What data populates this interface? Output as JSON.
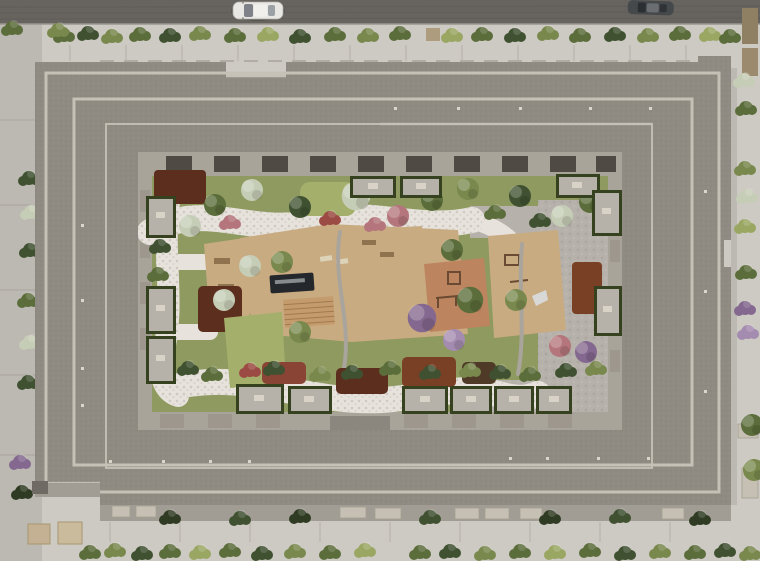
{
  "scene": {
    "type": "aerial-architectural-render",
    "description": "Top-down aerial render of a large rectangular residential block with stepped grey flat roofs and light parapet lines enclosing a landscaped inner courtyard. The courtyard holds winding white stone paths, a grey cobble plaza, lawns, dark red mulch beds, flowering shrubs, trees, tan and terracotta playgrounds, a dark reflecting pool with a wooden deck, and rows of private hedge-bordered terraces. Around the block: a dark asphalt road with a white car and a dark car at top, hedge strips, light sidewalks, a side street at left, and a hedge row at bottom."
  },
  "palette": {
    "road": "#67645f",
    "street": "#bcb8b2",
    "walk": "#cdc9c3",
    "roof": "#8f8a82",
    "parapet": "#c6c1b7",
    "facade": "#a9a49a",
    "facadedark": "#4f4b44",
    "courtyardbase": "#8e9a60",
    "pathwhite": "#e7e3dc",
    "cobble": "#b6b1aa",
    "tan": "#c9ab82",
    "terracotta": "#bd855f",
    "pool": "#24272b",
    "deck": "#c49b6c",
    "mulch": "#5c2e1e",
    "mulch2": "#7a4026",
    "lawn": "#a5af6c",
    "hedge": "#36421f",
    "patio": "#b7b2a9",
    "car_white": "#e9e7e3",
    "car_dark": "#46494c"
  },
  "objects": {
    "vehicles": [
      {
        "label": "white car on top road"
      },
      {
        "label": "dark car on top road"
      }
    ],
    "courtyard_features": [
      "white stone paths",
      "grey cobble plaza",
      "reflecting pool",
      "wood deck",
      "terracotta playground",
      "tan playground",
      "lawn patches",
      "mulch beds",
      "flowering shrubs",
      "private terraces with hedges"
    ],
    "surroundings": [
      "top road",
      "top hedge strip",
      "left side street",
      "right sidewalk with shrubs",
      "bottom sidewalk with awnings",
      "bottom hedge row"
    ]
  }
}
